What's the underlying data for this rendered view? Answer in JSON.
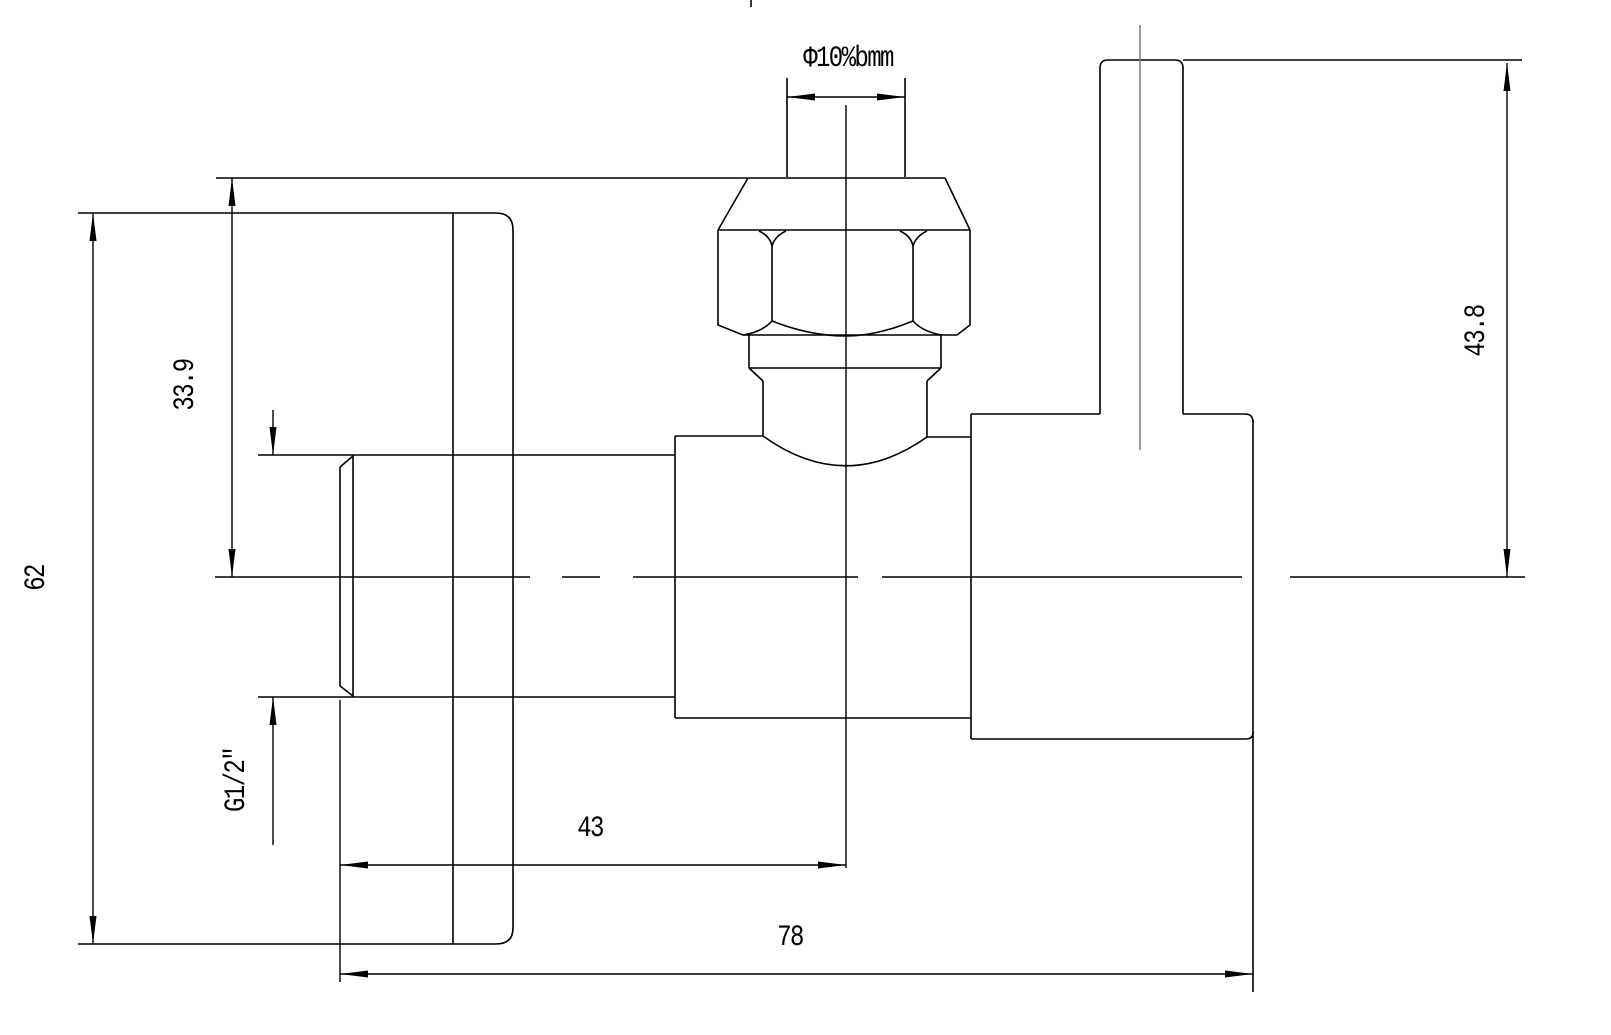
{
  "drawing": {
    "type": "cad-technical-drawing",
    "subject": "angle-valve-side-view",
    "background_color": "#ffffff",
    "line_color": "#000000",
    "centerline_color": "#808080",
    "labels": {
      "top_diameter": "Φ10%bmm",
      "nut_height": "33.9",
      "overall_height": "62",
      "thread_size": "G1/2\"",
      "outlet_height": "43.8",
      "inlet_offset": "43",
      "overall_width": "78"
    }
  }
}
